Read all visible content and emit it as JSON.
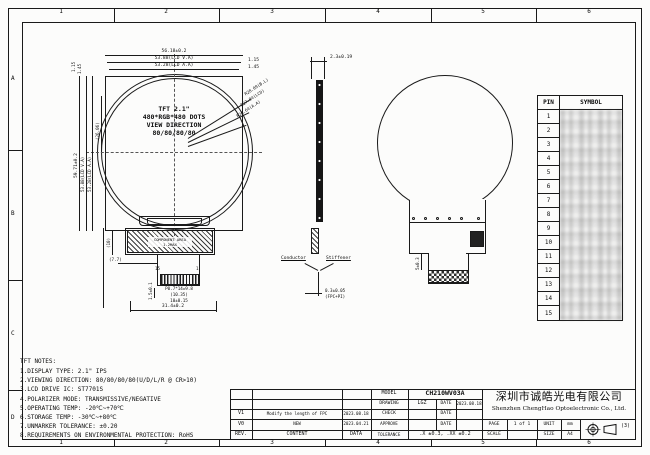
{
  "sheet": {
    "top_labels": [
      "1",
      "2",
      "3",
      "4",
      "5",
      "6"
    ],
    "bottom_labels": [
      "1",
      "2",
      "3",
      "4",
      "5",
      "6"
    ],
    "row_labels": [
      "A",
      "B",
      "C",
      "D"
    ]
  },
  "front_view": {
    "title_lines": [
      "TFT 2.1\"",
      "480*RGB*480 DOTS",
      "VIEW DIRECTION",
      "80/80/80/80"
    ],
    "dims": {
      "width_outline": "56.18±0.2",
      "width_va": "53.88(LCD V.A)",
      "width_aa": "53.28(LCD A.A)",
      "right_offset_1": "1.15",
      "right_offset_2": "1.45",
      "height_outline": "59.71±0.2",
      "height_va": "53.88(LCD V.A)",
      "height_aa": "53.28(LCD A.A)",
      "center_offset": "(26.06)",
      "left_offset_1": "1.15",
      "left_offset_2": "1.45",
      "radius_bl": "R28.09(B.L)",
      "radius_lcd": "R27.94(LCD)",
      "radius_aa": "R26.64(A.A)",
      "component_h": "(10)",
      "component_offset": "(7.7)",
      "conn_height": "1.5±0.1",
      "pin_pitch": "P0.7*14=9.8",
      "fpc_width": "(10.35)",
      "conn_width": "10±0.15",
      "tab_width": "31.4±0.2"
    },
    "component_area_label_1": "COMPONENT AREA",
    "component_area_label_2": "1.2MAX",
    "pin_first": "15",
    "pin_last": "1"
  },
  "side_view": {
    "thickness": "2.3±0.19",
    "conductor": "Conductor",
    "stiffener": "Stiffener",
    "fpc_thickness": "0.3±0.05",
    "fpc_thickness_note": "(FPC+PI)"
  },
  "back_view": {
    "dim": "5±0.3"
  },
  "pin_table": {
    "header_pin": "PIN",
    "header_symbol": "SYMBOL",
    "pins": [
      "1",
      "2",
      "3",
      "4",
      "5",
      "6",
      "7",
      "8",
      "9",
      "10",
      "11",
      "12",
      "13",
      "14",
      "15"
    ]
  },
  "notes": {
    "title": "TFT NOTES:",
    "lines": [
      "1.DISPLAY TYPE:  2.1\" IPS",
      "2.VIEWING DIRECTION: 80/80/80/80(U/D/L/R @ CR>10)",
      "3.LCD DRIVE IC: ST7701S",
      "4.POLARIZER MODE: TRANSMISSIVE/NEGATIVE",
      "5.OPERATING TEMP: -20℃~+70℃",
      "6.STORAGE TEMP: -30℃~+80℃",
      "7.UNMARKER TOLERANCE: ±0.20",
      "8.REQUIREMENTS ON ENVIRONMENTAL PROTECTION: RoHS"
    ]
  },
  "title_block": {
    "model_label": "MODEL",
    "model": "CH210WV03A",
    "drawing_label": "DRAWING",
    "drawing": "LGZ",
    "date_label": "DATE",
    "drawing_date": "2023.08.18",
    "check_label": "CHECK",
    "approve_label": "APPROVE",
    "tolerance_label": "TOLERANCE",
    "tolerance": ".X ±0.3, .XX ±0.2",
    "rev_label": "REV.",
    "content_label": "CONTENT",
    "data_label": "DATA",
    "revisions": [
      {
        "rev": "V1",
        "content": "Modify the length of FPC",
        "date": "2023.08.18"
      },
      {
        "rev": "V0",
        "content": "NEW",
        "date": "2023.04.21"
      }
    ],
    "company_cn": "深圳市诚皓光电有限公司",
    "company_en": "Shenzhen ChengHao Optoelectronic Co., Ltd.",
    "page_label": "PAGE",
    "page": "1 of 1",
    "unit_label": "UNIT",
    "unit": "mm",
    "scale_label": "SCALE",
    "size_label": "SIZE",
    "size": "A4",
    "projection": "(3)"
  }
}
